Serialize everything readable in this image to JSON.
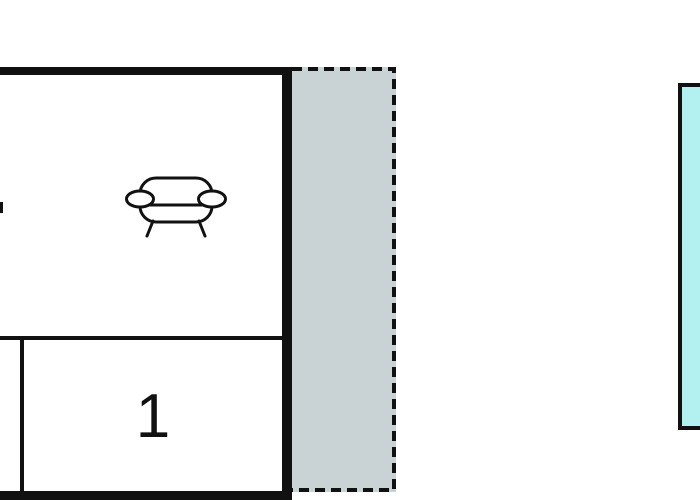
{
  "floorplan": {
    "room1_label": "1",
    "icons": [
      "sofa-icon"
    ],
    "areas": {
      "living_room": "room with sofa",
      "room_1": "room labeled 1",
      "terrace": "dashed outlined gray area",
      "pool": "cyan area at right edge"
    },
    "colors": {
      "wall": "#111111",
      "terrace": "#c9d3d6",
      "pool": "#b3f0f0",
      "background": "#ffffff"
    }
  }
}
